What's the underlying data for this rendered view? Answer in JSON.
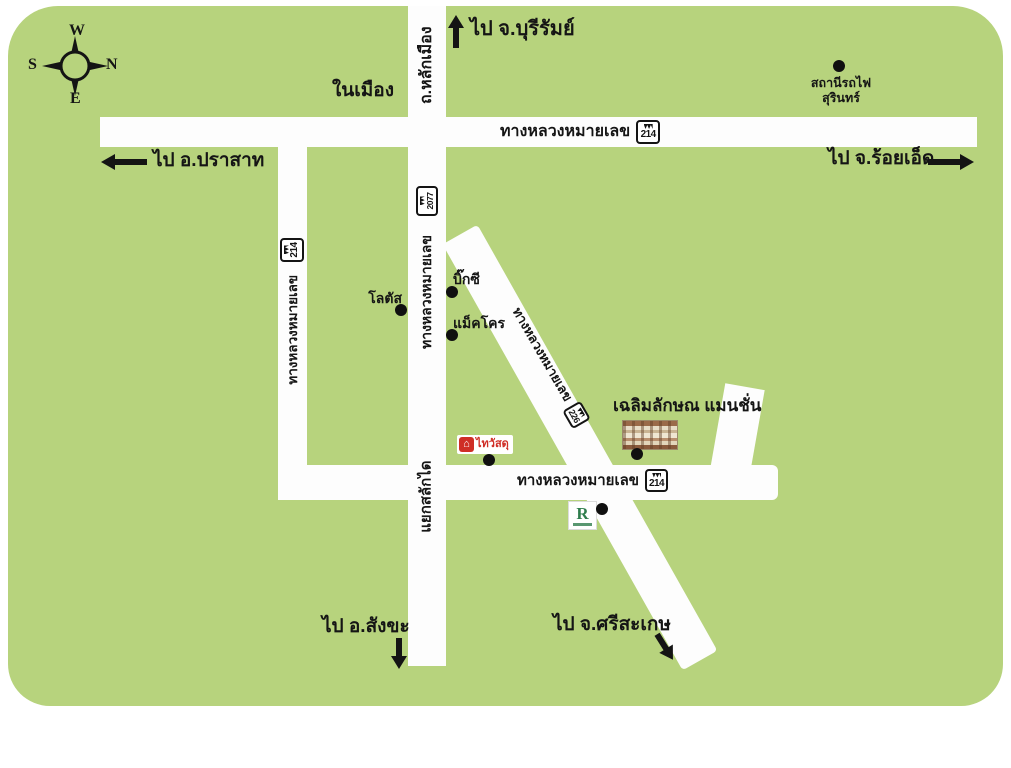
{
  "compass": {
    "top": "W",
    "right": "N",
    "left": "S",
    "bottom": "E"
  },
  "destinations": {
    "buriram": "ไป จ.บุรีรัมย์",
    "prasat": "ไป อ.ปราสาท",
    "roiet": "ไป จ.ร้อยเอ็ด",
    "sangkha": "ไป อ.สังขะ",
    "sisaket": "ไป จ.ศรีสะเกษ"
  },
  "area_label": "ในเมือง",
  "roads": {
    "highway_prefix": "ทางหลวงหมายเลข",
    "lak_mueang": "ถ.หลักเมือง",
    "salakdai_junction": "แยกสลักได",
    "shield_top": "214",
    "shield_left": "214",
    "shield_central": "2077",
    "shield_diagonal": "226",
    "shield_lower": "214"
  },
  "places": {
    "station_line1": "สถานีรถไฟ",
    "station_line2": "สุรินทร์",
    "lotus": "โลตัส",
    "bigc": "บิ๊กซี",
    "makro": "แม็คโคร",
    "mansion": "เฉลิมลักษณ แมนชั่น",
    "thaiwatsadu": "ไทวัสดุ",
    "r_logo": "R"
  },
  "colors": {
    "map_green": "#b7d37d",
    "road_white": "#fdfdfd",
    "watsadu_red": "#cf2e26",
    "r_logo_green": "#2f7d4d",
    "text_black": "#151515"
  }
}
